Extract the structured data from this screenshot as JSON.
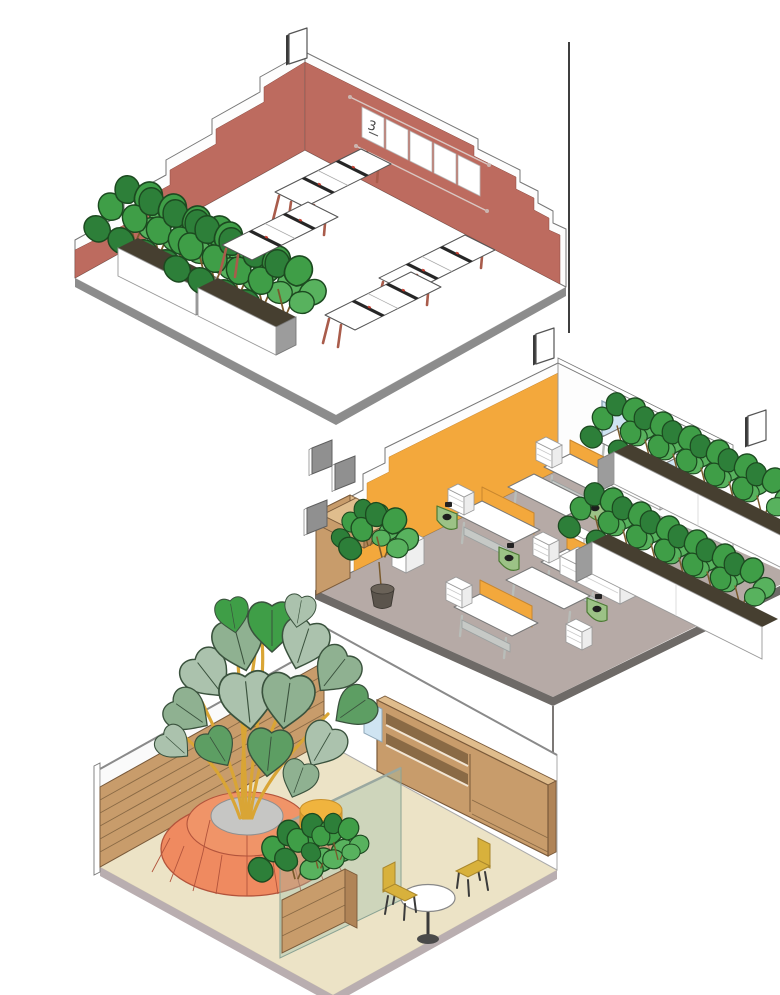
{
  "scene": {
    "type": "isometric cutaway illustration of three stacked office interiors",
    "background": "#ffffff",
    "rooms_count": 3
  },
  "colors": {
    "wall_red": "#bd6b5f",
    "wall_trim": "#fdfdfd",
    "floor_top": "#ffffff",
    "slab_top": "#8c8c8c",
    "wall_orange": "#f3a83c",
    "floor_middle": "#b6aaa6",
    "slab_middle": "#6e6a67",
    "window_blue": "#cfe4f2",
    "screen_orange": "#f3a83c",
    "desk_leg_red": "#a95c4b",
    "desk_leg_gray": "#b9bdb9",
    "tray_black": "#262626",
    "green_case": "#9cc286",
    "leaf_green": "#3f9e47",
    "leaf_green_dark": "#2d7f39",
    "leaf_green_light": "#58b25e",
    "sage": "#abc2ad",
    "sage_mid": "#8fb191",
    "sage_green": "#5d9e63",
    "stem_yellow": "#d9a535",
    "wood": "#c89c6b",
    "wood_light": "#e0bd8d",
    "wood_side": "#b08457",
    "floor_bottom": "#ece3c6",
    "slab_bottom": "#b9aeb0",
    "ottoman_coral": "#ef8a60",
    "ottoman_top": "#f09468",
    "planter_center_gray": "#c6c6c4",
    "pouf_yellow": "#f0b43e",
    "pouf_side": "#dd9e2f",
    "chair_yellow": "#d8b13c",
    "glass_green": "#9fc0ab",
    "soil": "#463f30",
    "outline": "#4a4a4a"
  },
  "rooms": {
    "top": {
      "name": "open office with stepped brick-red walls",
      "wall_color": "#bd6b5f",
      "floor_color": "#ffffff",
      "desk_benches": 4,
      "desks_per_bench": 2,
      "planter_boxes": 2,
      "whiteboard": {
        "panels": 5,
        "label": "3"
      },
      "sign_plates": 1
    },
    "middle": {
      "name": "open office with orange accent wall",
      "wall_color": "#f3a83c",
      "floor_color": "#b6aaa6",
      "windows": 2,
      "desk_benches": 4,
      "divider_screen_color": "#f3a83c",
      "planter_rows": 2,
      "green_floor_units": 4,
      "acoustic_panels": 3,
      "sign_plates": 2,
      "kitchen_counter": 1
    },
    "bottom": {
      "name": "lounge with indoor tree",
      "floor_color": "#ece3c6",
      "slat_walls": 1,
      "shelf_units": 1,
      "glass_partitions": 1,
      "ottoman_planters": 1,
      "poufs": 1,
      "cafe_tables": 1,
      "cafe_chairs": 2,
      "planter_boxes": 1
    }
  }
}
